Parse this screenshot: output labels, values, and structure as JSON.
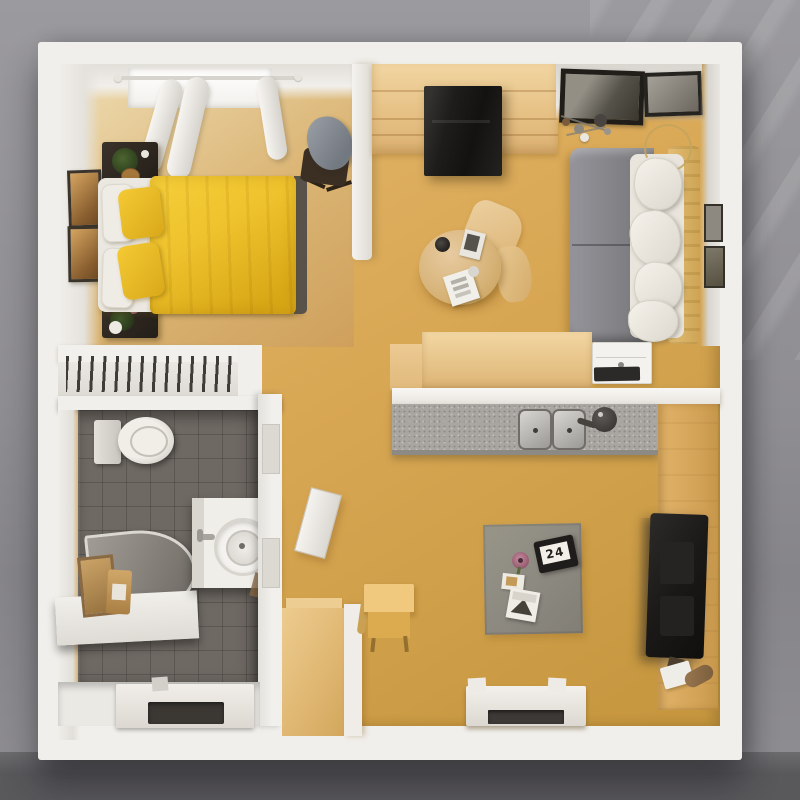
{
  "scene": {
    "description": "3D rendered top-down floor plan of a one-bedroom apartment",
    "rug_card_text": "24"
  },
  "palette": {
    "bg_top": "#9b9a9e",
    "bg_mid": "#8f8e92",
    "bg_bottom": "#59585b",
    "wall_white": "#f1efeb",
    "floor_gold": "#d9a855",
    "floor_gold_light": "#e4b86e",
    "floor_gold_dark": "#c6973f",
    "bedroom_floor": "#dab473",
    "bed_yellow": "#eec22c",
    "bed_frame": "#59524a",
    "nightstand_dark": "#2e2720",
    "wardrobe_tan": "#e8c286",
    "cabinet_black": "#1f1d1b",
    "sofa_gray": "#87878b",
    "cushion_white": "#e9e5dd",
    "throw_tan": "#d9b264",
    "counter_gray": "#a9a6a1",
    "console_tan": "#d2a256",
    "tv_black": "#1d1b19",
    "tile_gray": "#6f6963",
    "bath_floor": "#ebe9e4",
    "fixture_white": "#f0eee9",
    "shower_gray": "#8b867f",
    "rug_gray": "#8f8c84",
    "mat_dark": "#3b3834",
    "dresser_tan": "#e2bc7a",
    "art_amber": "#c59150"
  },
  "objects": {
    "rooms": [
      "bedroom",
      "hallway-wardrobe",
      "living-room",
      "kitchen",
      "bathroom"
    ],
    "furniture": [
      "double-bed",
      "nightstands",
      "rocking-chair",
      "wardrobe",
      "black-cabinet",
      "dining-table",
      "chairs",
      "sofa",
      "kitchen-counter",
      "double-sink",
      "tv-console",
      "tv",
      "toilet",
      "shower-tray",
      "vanity-sink",
      "wall-shelf",
      "rug",
      "dresser",
      "wall-desk",
      "door-mats"
    ]
  }
}
